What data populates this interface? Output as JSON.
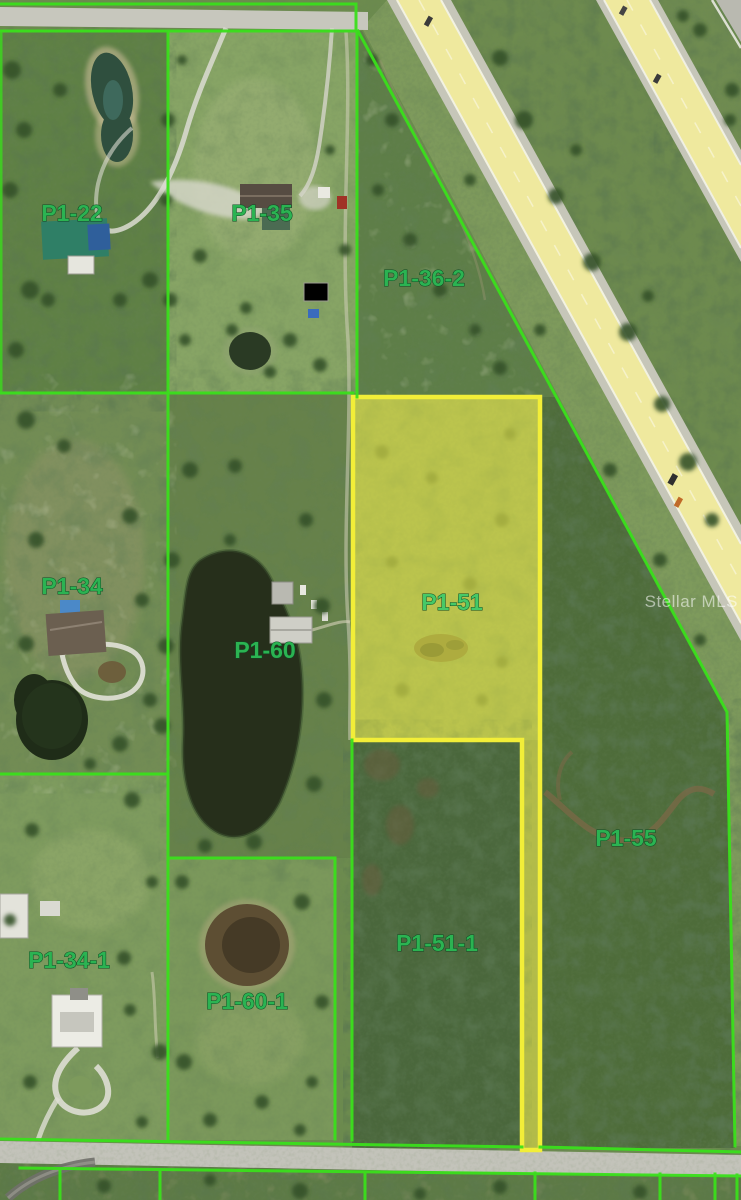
{
  "title": "Aerial parcel map photo",
  "watermark": {
    "text": "Stellar MLS"
  },
  "map": {
    "highlighted_parcel_id": "P1-51",
    "colors": {
      "boundary_green": "#3ae01c",
      "highlight_yellow": "#f2ee38",
      "label_green": "#2bb352",
      "highlight_label_green": "#46c968",
      "highway_yellow": "#efe99e",
      "road_gray": "#c7c7bd"
    }
  },
  "parcels": [
    {
      "id": "P1-22",
      "highlighted": false
    },
    {
      "id": "P1-35",
      "highlighted": false
    },
    {
      "id": "P1-36-2",
      "highlighted": false
    },
    {
      "id": "P1-34",
      "highlighted": false
    },
    {
      "id": "P1-60",
      "highlighted": false
    },
    {
      "id": "P1-51",
      "highlighted": true
    },
    {
      "id": "P1-55",
      "highlighted": false
    },
    {
      "id": "P1-34-1",
      "highlighted": false
    },
    {
      "id": "P1-60-1",
      "highlighted": false
    },
    {
      "id": "P1-51-1",
      "highlighted": false
    }
  ]
}
